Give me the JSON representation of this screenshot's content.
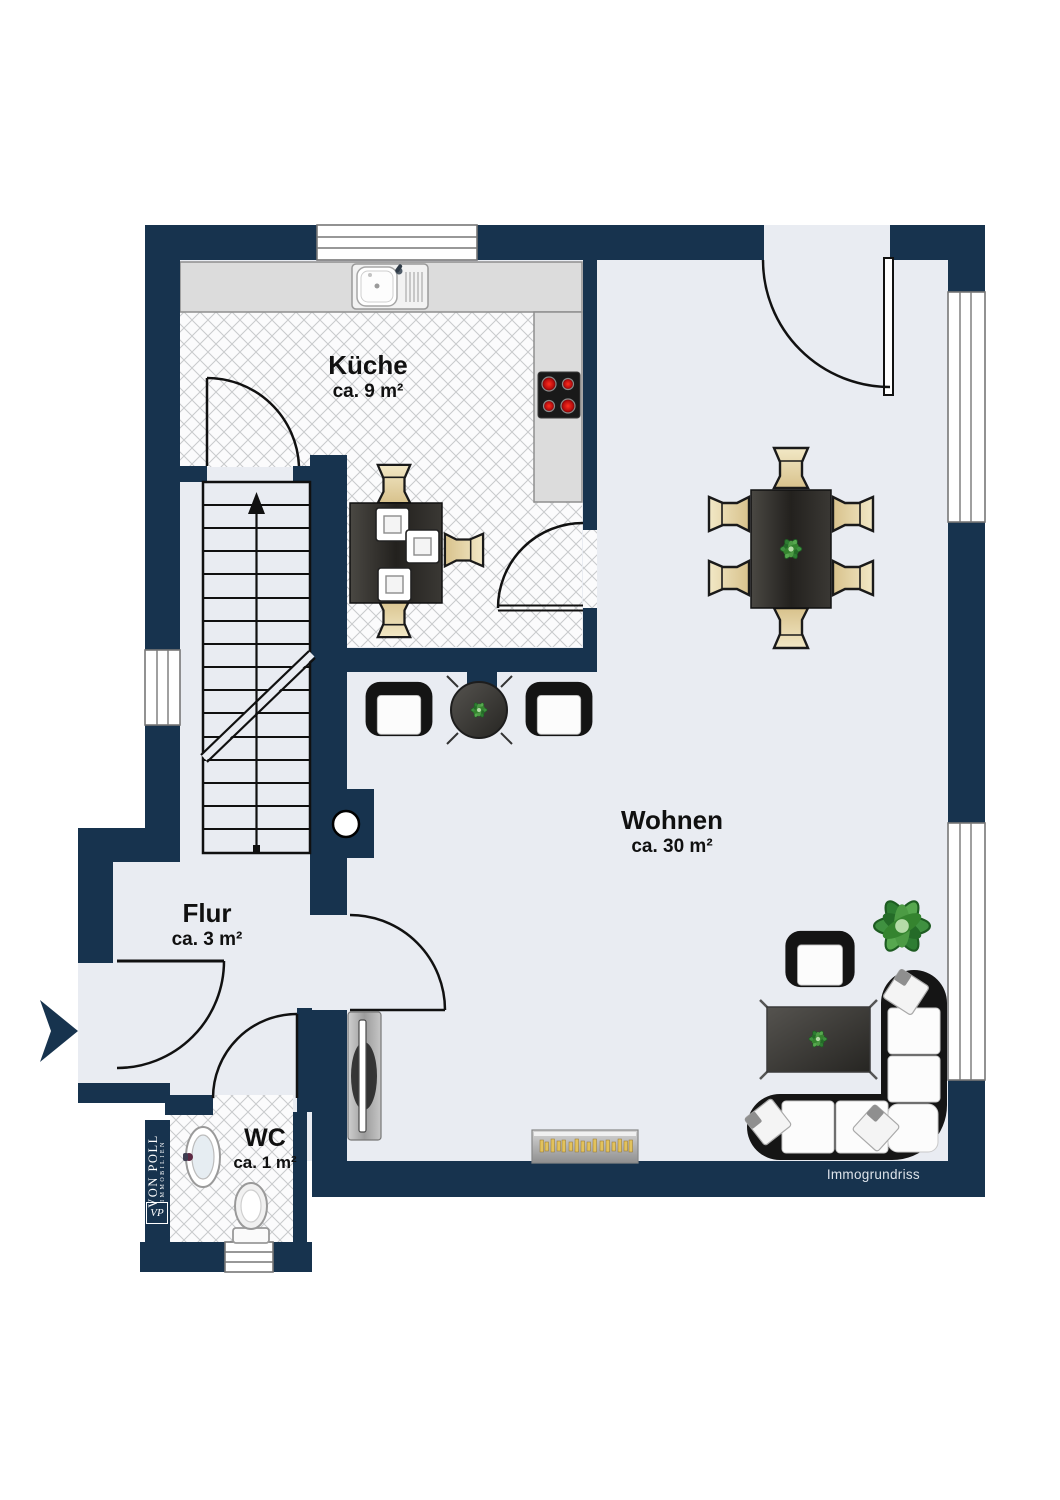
{
  "plan": {
    "type": "floorplan",
    "floor_rooms_total": 4,
    "colors": {
      "wall_navy": "#17334E",
      "floor_light": "#E9ECF2",
      "tile_line": "#C8CACC",
      "counter_gray": "#DCDCDC",
      "burner_red": "#CC1111",
      "chair_beige": "#E7D9A8",
      "table_dark": "#2E2C29",
      "sofa_black": "#151515",
      "plant_green": "#3F8F40",
      "piano_gold": "#E2C25C"
    }
  },
  "rooms": [
    {
      "id": "kueche",
      "label": "Küche",
      "area": "ca. 9 m²"
    },
    {
      "id": "wohnen",
      "label": "Wohnen",
      "area": "ca. 30 m²"
    },
    {
      "id": "flur",
      "label": "Flur",
      "area": "ca. 3 m²"
    },
    {
      "id": "wc",
      "label": "WC",
      "area": "ca. 1 m²"
    }
  ],
  "branding": {
    "brand_name": "VON POLL",
    "brand_sub": "IMMOBILIEN",
    "vp_monogram": "VP",
    "watermark": "Immogrundriss"
  }
}
